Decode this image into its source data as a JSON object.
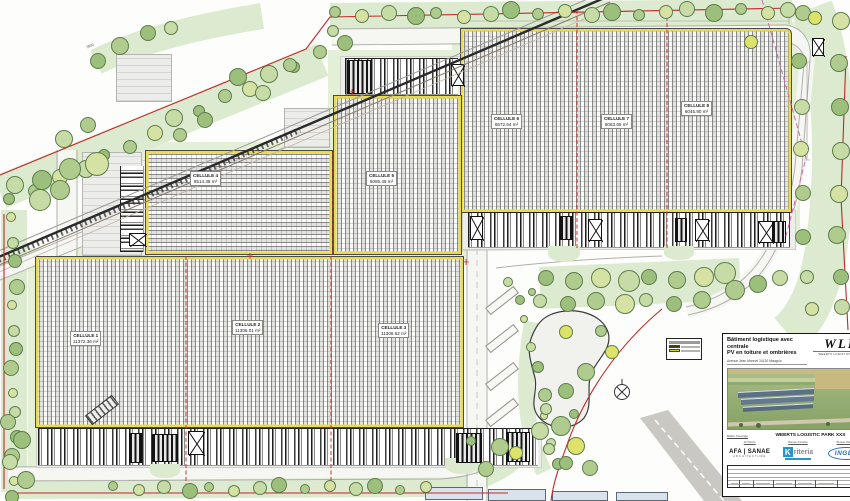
{
  "drawing": {
    "kind": "site-plan",
    "railway_dim_label": "7800"
  },
  "cells": [
    {
      "name": "CELLULE 1",
      "area": "11372.36 m²"
    },
    {
      "name": "CELLULE 2",
      "area": "11306.01 m²"
    },
    {
      "name": "CELLULE 3",
      "area": "11306.62 m²"
    },
    {
      "name": "CELLULE 4",
      "area": "8514.38 m²"
    },
    {
      "name": "CELLULE 5",
      "area": "6085.49 m²"
    },
    {
      "name": "CELLULE 6",
      "area": "6572.64 m²"
    },
    {
      "name": "CELLULE 7",
      "area": "6063.65 m²"
    },
    {
      "name": "CELLULE 8",
      "area": "6045.90 m²"
    }
  ],
  "legend": {
    "swatches": [
      "#3f3a18",
      "#c7d632"
    ]
  },
  "title_block": {
    "title_line1": "Bâtiment logistique avec centrale",
    "title_line2": "PV en toiture et ombrières",
    "address": "Avenue Jean Monnet 34130 Mauguio",
    "logo_main": "WLP",
    "logo_sub": "WEERTS LOGISTICS PARKS",
    "project_label": "Maître d'ouvrage",
    "project_name": "WEERTS LOGISTIC PARK XXX",
    "partners": [
      {
        "label": "Architecte",
        "name": "AFA | SANAE",
        "sub": "ARCHITECTURE"
      },
      {
        "label": "Bureau d'études",
        "name": "riteria",
        "initial": "K"
      },
      {
        "label": "Bureau d'études",
        "name": "INGEA"
      }
    ]
  },
  "icons": {
    "north_arrow": "circled-cross-compass",
    "crossed_box": "x-framed-opening",
    "tree": "green-circle"
  },
  "colors": {
    "boundary_red": "#c22828",
    "boundary_magenta": "#cf6aae",
    "building_edge_yellow": "#e8da52",
    "verge_green": "#e3efd7",
    "band_green": "#dcead0",
    "tree_greens": [
      "#afcb8d",
      "#9cbf7c",
      "#c6dba6",
      "#d5e2a4",
      "#dde26a"
    ],
    "hatch_gray": "#8a8a8a",
    "ombriere_blue": "#d9e3ee",
    "kriteria_blue": "#2795c9",
    "ingea_blue": "#2a6fb0"
  }
}
